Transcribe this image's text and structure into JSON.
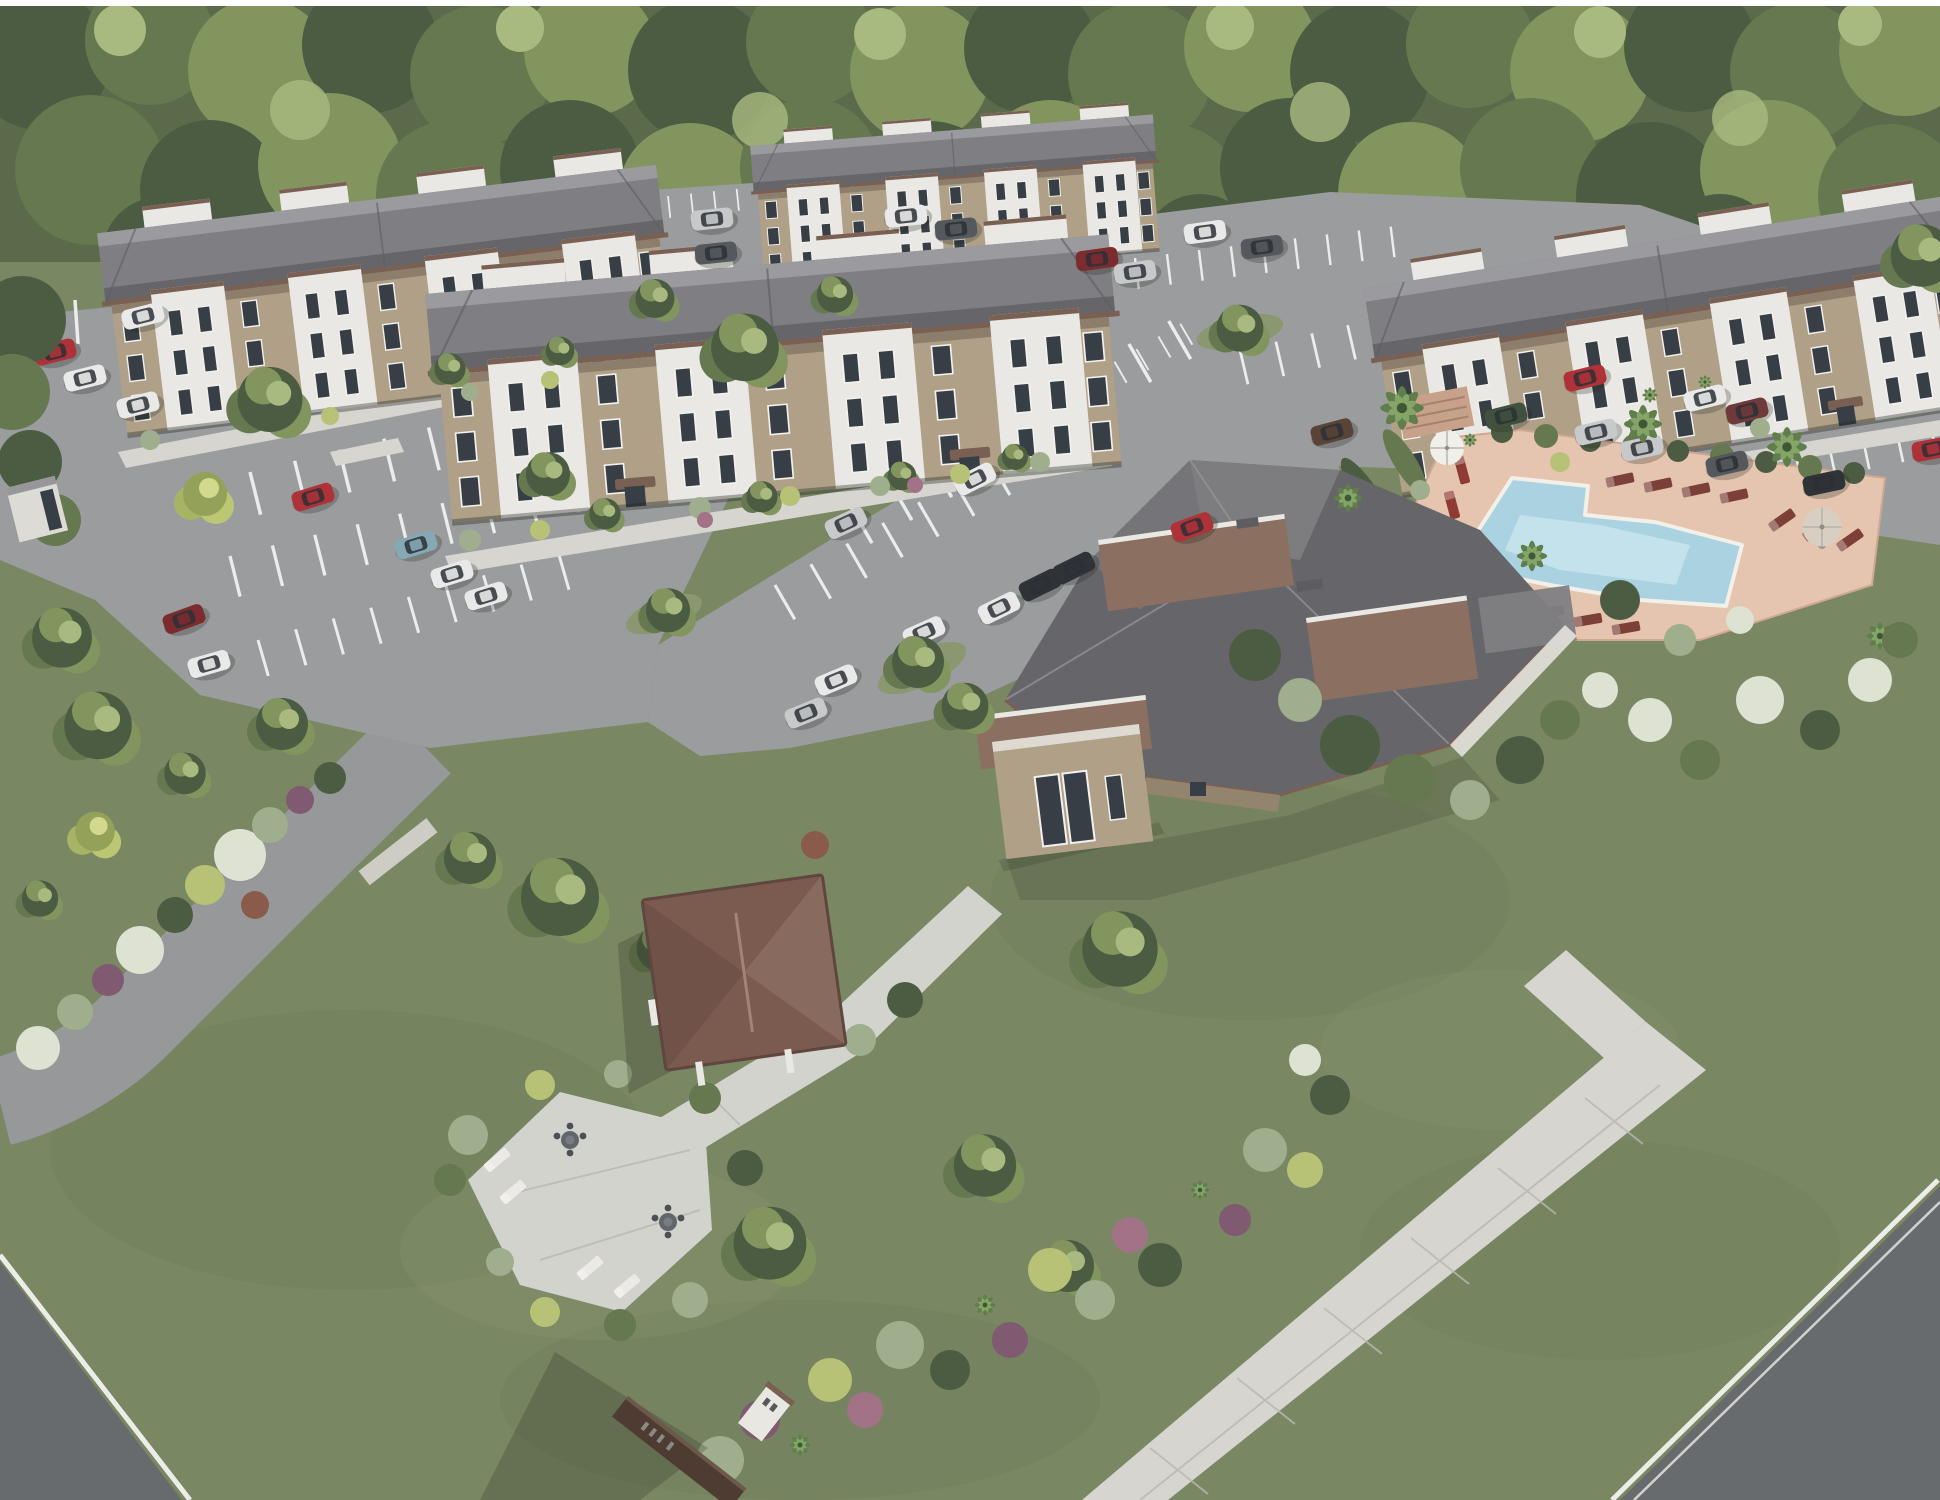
{
  "scene": {
    "type": "architectural-rendering",
    "view": "aerial-oblique",
    "description": "Aerial 3D architectural rendering of a garden-style apartment community: four three-story tan-and-white apartment buildings with gray hip roofs, surface parking lots with parked cars, a central clubhouse with a swimming pool and lounge-chair deck, palm trees, a picnic pavilion with patio furniture, landscaped beds, lawns, a monument sign, and a dense tree line in the background."
  },
  "site": {
    "buildings": [
      {
        "label": "apartment-building-west",
        "stories": 3
      },
      {
        "label": "apartment-building-north",
        "stories": 3
      },
      {
        "label": "apartment-building-center",
        "stories": 3
      },
      {
        "label": "apartment-building-east",
        "stories": 3
      }
    ],
    "amenities": [
      "clubhouse",
      "clubhouse-entry-tower",
      "swimming-pool",
      "pool-deck-with-loungers",
      "pool-umbrellas",
      "picnic-pavilion",
      "patio-with-tables-and-loungers",
      "monument-sign"
    ],
    "landscape": [
      "perimeter-tree-line",
      "lawns",
      "landscape-beds",
      "shade-trees",
      "palm-trees",
      "parking-islands",
      "hedges"
    ],
    "infrastructure": [
      "surface-parking-lots",
      "parking-stripes",
      "parked-cars",
      "driveways",
      "sidewalks",
      "perimeter-streets",
      "mail-kiosk"
    ]
  },
  "palette": {
    "treeDark": "#4c5c42",
    "treeMid": "#66784f",
    "treeLight": "#82955e",
    "treeHi": "#a9ba80",
    "lawn": "#7a8763",
    "lawnDark": "#6d7a58",
    "lawnLight": "#8a9770",
    "asphalt": "#9b9c9e",
    "stripe": "#ececec",
    "sidewalk": "#d6d5d0",
    "sidewalkLine": "#b9b8b2",
    "roadDark": "#686b6d",
    "curbWhite": "#ecece9",
    "roofDark": "#66666a",
    "roofMid": "#7f7f83",
    "roofRidge": "#9b9b9f",
    "fascia": "#7a6052",
    "flatRoofBrown": "#8b6f60",
    "wallTan": "#b0a088",
    "wallTanDark": "#93846d",
    "wallWhite": "#eae8e4",
    "windowGlass": "#383e45",
    "poolDeck": "#e5c5af",
    "poolWater": "#aad2e1",
    "poolWaterLight": "#cde8f0",
    "poolCoping": "#f2f0e8",
    "patio": "#d3d3cd",
    "pavilionRoof": "#7b5b50",
    "pavilionRoofDark": "#67493f",
    "pavilionRoofLight": "#937467",
    "signBrown": "#4e3c33",
    "shadow": "rgba(35,45,30,0.30)",
    "shrubPurple": "#7f5a71",
    "shrubPurpleLight": "#a27287",
    "shrubYellowGreen": "#b7c277",
    "shrubSage": "#9fae8c",
    "shrubWhite": "#dde2d2",
    "agaveGreen": "#9db47e",
    "carWhite": "#e9e9e9",
    "carSilver": "#c7c9cb",
    "carRed": "#ae3238",
    "carDarkRed": "#7c2b2f",
    "carBlack": "#2f3236",
    "carGray": "#55585c",
    "carGreen": "#41503f",
    "carTeal": "#85aab6",
    "carBrown": "#5a4337",
    "carMaroon": "#6e3a3b",
    "loungerBrown": "#7c4038",
    "loungerRed": "#8e3b33",
    "loungerWhite": "#eceae6",
    "umbrellaWhite": "#f0efe9",
    "umbrellaTan": "#d8cfc2",
    "frame": "#ffffff"
  }
}
